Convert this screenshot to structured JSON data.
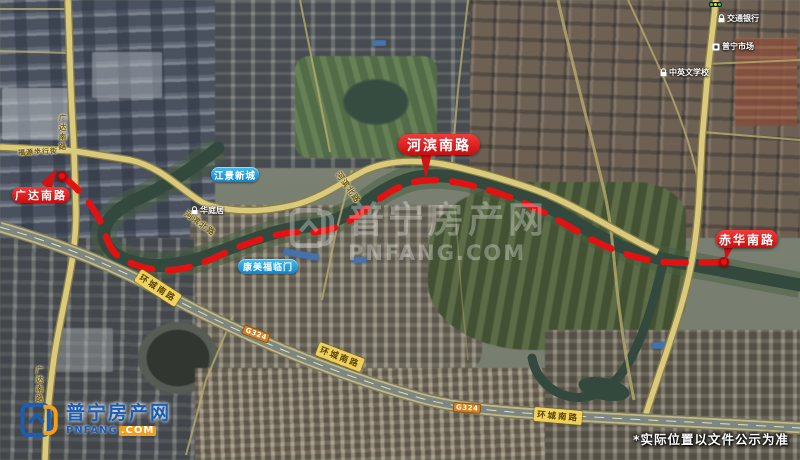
{
  "map_labels": {
    "red_markers": [
      {
        "text": "广达南路"
      },
      {
        "text": "河滨南路"
      },
      {
        "text": "赤华南路"
      }
    ],
    "blue_pois": [
      {
        "text": "江景新城"
      },
      {
        "text": "康美福临门"
      }
    ],
    "road_names": {
      "guangda_nanlu": "广达南路",
      "hebin_beilu": "河滨北路",
      "huancheng_nanlu": "环城南路",
      "g324": "G324",
      "fuyuan_street": "福源步行街"
    },
    "poi_names": [
      {
        "text": "华庭居"
      },
      {
        "text": "交通银行"
      },
      {
        "text": "普宁市场"
      },
      {
        "text": "中英文学校"
      }
    ]
  },
  "watermark": {
    "brand": "普宁房产网",
    "domain": "PNFANG.COM"
  },
  "logo": {
    "brand": "普宁房产网",
    "domain_name": "PNFANG",
    "domain_tld": ".COM"
  },
  "disclaimer": "*实际位置以文件公示为准",
  "colors": {
    "route_red": "#e31212",
    "marker_blue": "#22a0e8",
    "road_yellow": "#d9ca7e",
    "water_green": "#33493d",
    "brand_blue": "#1a5db5",
    "brand_orange": "#f59e1c"
  }
}
